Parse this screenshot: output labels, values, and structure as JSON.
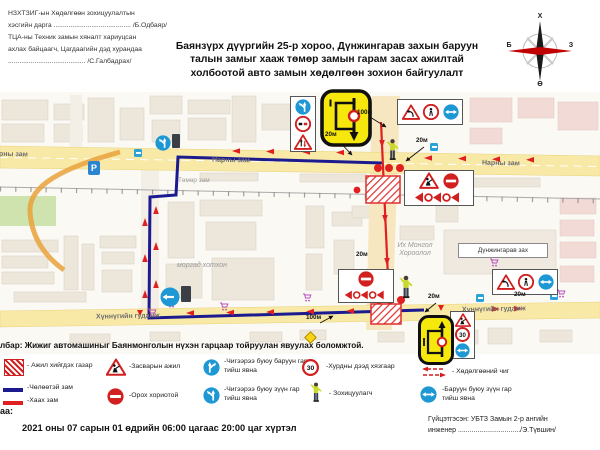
{
  "header": {
    "approval_lines": [
      "НЗХТЗИГ-ын Хөдөлгөөн зохицуулалтын",
      "хэсгийн дарга ......................................... /Б.Одбаяр/",
      "ТЦА-ны Техник замын хяналт хариуцсан",
      "ахлах байцаагч, Цагдаагийн дэд хурандаа",
      "......................................... /С.Галбадрах/"
    ],
    "title": "Баянзүрх дүүргийн 25-р хороо, Дүнжингарав захын баруун талын замыг хааж төмөр замын гарам засах ажилтай холбоотой авто замын хөдөлгөөн зохион байгуулалт",
    "compass": {
      "n": "Х",
      "e": "З",
      "s": "Ө",
      "w": "Б"
    }
  },
  "map": {
    "streets": {
      "narny": "Нарны зам",
      "tumur": "Төмөр зам",
      "khunnu": "Хүннүгийн гудамж"
    },
    "places": {
      "morgad": "моргад хотхон",
      "ikh_mongol": "Их Монгол Хороолол",
      "dunjingarav": "Дүнжингарав зах"
    },
    "labels": {
      "m100": "100м",
      "m20": "20м"
    },
    "parking": "P",
    "speed_limit": "30"
  },
  "note": "лбар: Жижиг автомашиныг Баянмонголын нүхэн гарцаар тойруулан явуулах боломжтой.",
  "legend": {
    "work_area": "- Ажил хийгдэх газар",
    "free_road": "-Чөлөөтэй зам",
    "closed_road": "-Хаах зам",
    "repair": "-Засварын ажил",
    "no_entry": "-Орох хориотой",
    "straight_or_right": "-Чигээрээ буюу баруун гар тийш явна",
    "straight_or_left": "-Чигээрээ буюу зүүн гар тийш явна",
    "speed_limit": "-Хурдны дээд хязгаар",
    "controller": "- Зохицуулагч",
    "direction": "- Хөдөлгөөний чиг",
    "right_or_left": "-Баруун буюу зүүн гар тийш явна"
  },
  "footer": {
    "period_label": "аа:",
    "period": "2021 оны 07 сарын 01 өдрийн 06:00 цагаас  20:00 цаг хүртэл",
    "executor_line1": "Гүйцэтгэсэн: УБТЗ Замын 2-р ангийн",
    "executor_line2": "инженер ................................/Э.Түвшин/"
  }
}
